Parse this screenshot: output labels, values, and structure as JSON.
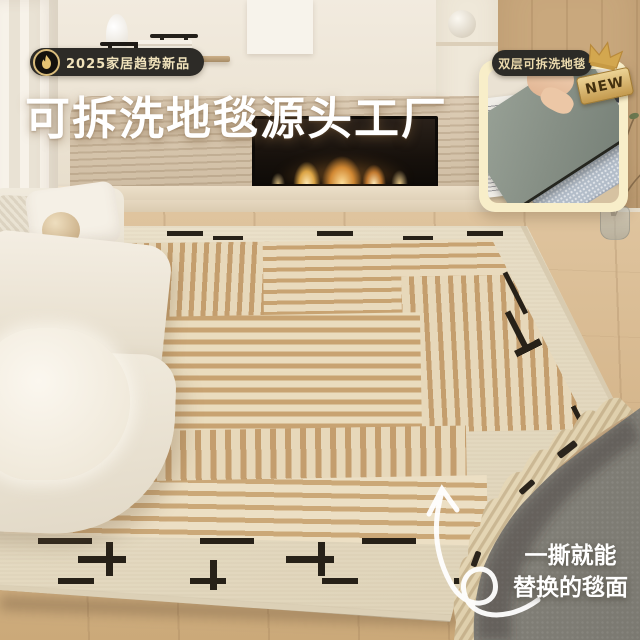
{
  "title": {
    "text": "可拆洗地毯源头工厂"
  },
  "promo_badge": {
    "label": "2025家居趋势新品",
    "icon": "flame-icon"
  },
  "inset_card": {
    "tab_label": "双层可拆洗地毯",
    "new_label": "NEW",
    "crown_icon": "crown-icon"
  },
  "callout": {
    "line1": "一撕就能",
    "line2": "替换的毯面",
    "icon": "curved-arrow-icon"
  },
  "colors": {
    "badge_bg": "#2d2b27",
    "badge_text": "#f0e2bb",
    "badge_gold": "#e4c273",
    "title_text": "#ffffff",
    "card_bg": "#f8eec9",
    "tab_bg": "#2c2b27",
    "tab_text": "#ead9ac",
    "new_bg": "#d9b468",
    "new_text": "#43300f",
    "crown_gold": "#d3a74f",
    "callout_text": "#ffffff",
    "rug_tan": "#c49e6e",
    "rug_cream": "#e7d8ba",
    "rug_border": "#ece3cd",
    "rug_dash_black": "#272118",
    "underlay_gray": "#8b8981",
    "floor_wood": "#d8bc95",
    "stone_beige": "#d8c8b1",
    "flame_orange": "#f4a94f"
  }
}
